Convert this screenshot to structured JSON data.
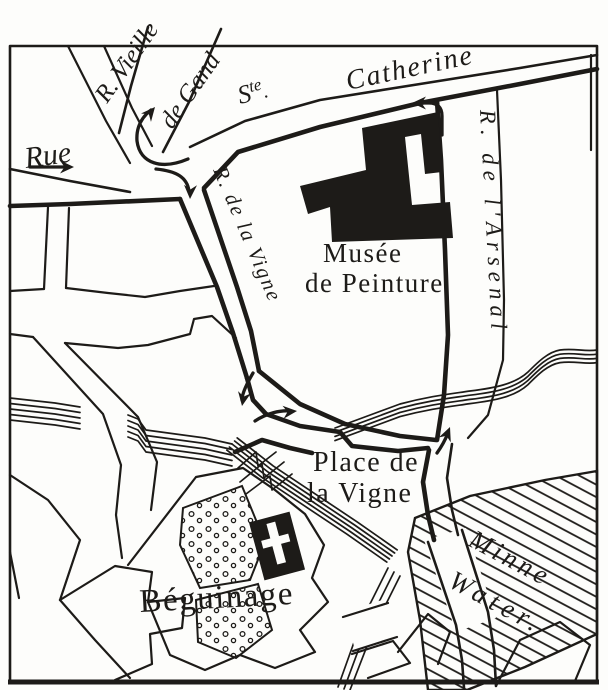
{
  "map": {
    "kind": "vintage-engraved-street-map",
    "colors": {
      "ink": "#1d1b18",
      "paper": "#fdfdfb"
    },
    "labels": {
      "rue": "Rue",
      "ste_s": "S",
      "ste_sup": "te",
      "ste_dot": ".",
      "catherine": "Catherine",
      "r_vieille": "R. Vieille",
      "de_gand": "de Gand",
      "r_de_la_vigne": "R. de la Vigne",
      "musee_line1": "Musée",
      "musee_line2": "de Peinture",
      "place_line1": "Place de",
      "place_line2": "la Vigne",
      "beguinage": "Béguinage",
      "minne": "Minne",
      "water": "Water.",
      "r_arsenal": "R. de l'Arsenal"
    }
  }
}
